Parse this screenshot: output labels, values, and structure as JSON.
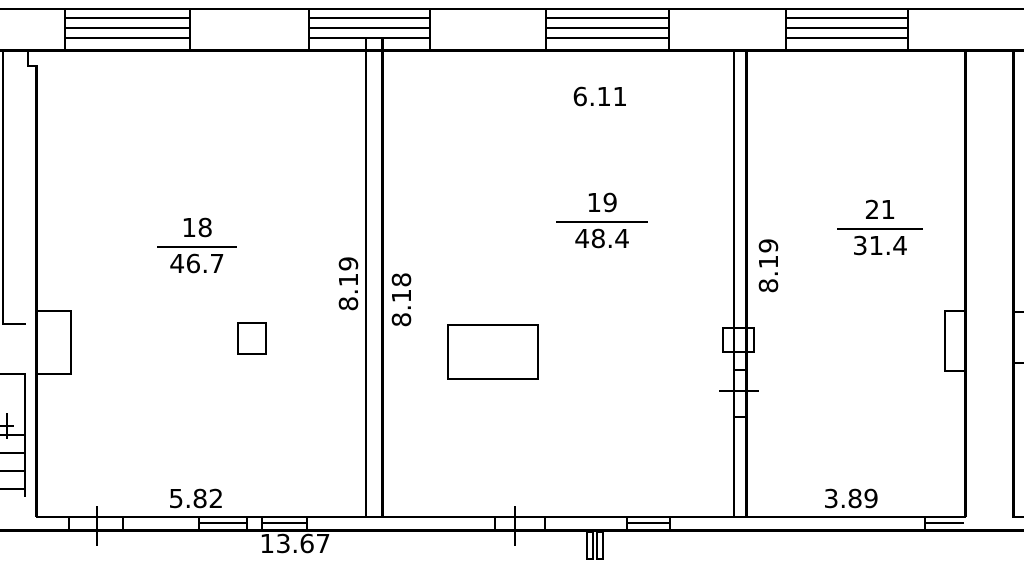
{
  "canvas": {
    "width": 1024,
    "height": 563,
    "bg": "#ffffff",
    "stroke": "#000000"
  },
  "rooms": [
    {
      "number": "18",
      "area": "46.7"
    },
    {
      "number": "19",
      "area": "48.4"
    },
    {
      "number": "21",
      "area": "31.4"
    }
  ],
  "dims": [
    {
      "text": "6.11"
    },
    {
      "text": "8.19"
    },
    {
      "text": "8.18"
    },
    {
      "text": "8.19"
    },
    {
      "text": "5.82"
    },
    {
      "text": "13.67"
    },
    {
      "text": "3.89"
    }
  ],
  "plan": {
    "rects": [
      {
        "name": "top-outer-wall-line",
        "x": 0,
        "y": 8,
        "w": 1024,
        "h": 2
      },
      {
        "name": "top-inner-wall-line",
        "x": 0,
        "y": 49,
        "w": 1024,
        "h": 3
      },
      {
        "name": "window-jamb",
        "x": 64,
        "y": 8,
        "w": 2,
        "h": 44
      },
      {
        "name": "window-jamb",
        "x": 189,
        "y": 8,
        "w": 2,
        "h": 44
      },
      {
        "name": "window-jamb",
        "x": 308,
        "y": 8,
        "w": 2,
        "h": 44
      },
      {
        "name": "window-jamb",
        "x": 429,
        "y": 8,
        "w": 2,
        "h": 44
      },
      {
        "name": "window-jamb",
        "x": 545,
        "y": 8,
        "w": 2,
        "h": 44
      },
      {
        "name": "window-jamb",
        "x": 668,
        "y": 8,
        "w": 2,
        "h": 44
      },
      {
        "name": "window-jamb",
        "x": 785,
        "y": 8,
        "w": 2,
        "h": 44
      },
      {
        "name": "window-jamb",
        "x": 907,
        "y": 8,
        "w": 2,
        "h": 44
      },
      {
        "name": "window-pane-line",
        "x": 66,
        "y": 17,
        "w": 123,
        "h": 2
      },
      {
        "name": "window-pane-line",
        "x": 66,
        "y": 27,
        "w": 123,
        "h": 2
      },
      {
        "name": "window-pane-line",
        "x": 66,
        "y": 37,
        "w": 123,
        "h": 2
      },
      {
        "name": "window-pane-line",
        "x": 310,
        "y": 17,
        "w": 119,
        "h": 2
      },
      {
        "name": "window-pane-line",
        "x": 310,
        "y": 27,
        "w": 119,
        "h": 2
      },
      {
        "name": "window-pane-line",
        "x": 310,
        "y": 37,
        "w": 119,
        "h": 2
      },
      {
        "name": "window-pane-line",
        "x": 547,
        "y": 17,
        "w": 121,
        "h": 2
      },
      {
        "name": "window-pane-line",
        "x": 547,
        "y": 27,
        "w": 121,
        "h": 2
      },
      {
        "name": "window-pane-line",
        "x": 547,
        "y": 37,
        "w": 121,
        "h": 2
      },
      {
        "name": "window-pane-line",
        "x": 787,
        "y": 17,
        "w": 120,
        "h": 2
      },
      {
        "name": "window-pane-line",
        "x": 787,
        "y": 27,
        "w": 120,
        "h": 2
      },
      {
        "name": "window-pane-line",
        "x": 787,
        "y": 37,
        "w": 120,
        "h": 2
      },
      {
        "name": "left-outer-wall-line",
        "x": 2,
        "y": 51,
        "w": 2,
        "h": 274
      },
      {
        "name": "stair-landing-line",
        "x": 2,
        "y": 323,
        "w": 24,
        "h": 2
      },
      {
        "name": "stair-landing-line",
        "x": 0,
        "y": 373,
        "w": 26,
        "h": 2
      },
      {
        "name": "stair-stringer-line",
        "x": 24,
        "y": 375,
        "w": 2,
        "h": 122
      },
      {
        "name": "stair-cross-mark-h",
        "x": 0,
        "y": 425,
        "w": 14,
        "h": 2
      },
      {
        "name": "stair-cross-mark-v",
        "x": 6,
        "y": 413,
        "w": 2,
        "h": 26
      },
      {
        "name": "stair-step-line",
        "x": 0,
        "y": 434,
        "w": 26,
        "h": 2
      },
      {
        "name": "stair-step-line",
        "x": 0,
        "y": 452,
        "w": 26,
        "h": 2
      },
      {
        "name": "stair-step-line",
        "x": 0,
        "y": 470,
        "w": 26,
        "h": 2
      },
      {
        "name": "stair-step-line",
        "x": 0,
        "y": 488,
        "w": 26,
        "h": 2
      },
      {
        "name": "wall-notch-v",
        "x": 27,
        "y": 51,
        "w": 2,
        "h": 16
      },
      {
        "name": "wall-notch-h",
        "x": 27,
        "y": 65,
        "w": 11,
        "h": 2
      },
      {
        "name": "room18-left-wall",
        "x": 35,
        "y": 65,
        "w": 3,
        "h": 452
      },
      {
        "name": "wall-18-19-left-line",
        "x": 365,
        "y": 38,
        "w": 2,
        "h": 479
      },
      {
        "name": "wall-18-19-right-line",
        "x": 381,
        "y": 38,
        "w": 3,
        "h": 479
      },
      {
        "name": "wall-19-21-left-line",
        "x": 733,
        "y": 51,
        "w": 2,
        "h": 466
      },
      {
        "name": "wall-19-21-right-line",
        "x": 745,
        "y": 51,
        "w": 3,
        "h": 466
      },
      {
        "name": "door-jamb-line",
        "x": 733,
        "y": 369,
        "w": 15,
        "h": 2
      },
      {
        "name": "dimension-tick",
        "x": 719,
        "y": 390,
        "w": 40,
        "h": 2
      },
      {
        "name": "door-jamb-line",
        "x": 733,
        "y": 416,
        "w": 15,
        "h": 2
      },
      {
        "name": "room21-right-wall",
        "x": 964,
        "y": 51,
        "w": 3,
        "h": 466
      },
      {
        "name": "shaft-right-wall",
        "x": 1012,
        "y": 51,
        "w": 3,
        "h": 466
      },
      {
        "name": "edge-tick",
        "x": 1015,
        "y": 311,
        "w": 9,
        "h": 2
      },
      {
        "name": "edge-tick",
        "x": 1015,
        "y": 362,
        "w": 9,
        "h": 2
      },
      {
        "name": "bottom-outer-wall-line",
        "x": 0,
        "y": 529,
        "w": 1024,
        "h": 3
      },
      {
        "name": "bottom-inner-wall-line",
        "x": 36,
        "y": 516,
        "w": 930,
        "h": 2
      },
      {
        "name": "bottom-inner-wall-line",
        "x": 1012,
        "y": 516,
        "w": 12,
        "h": 2
      },
      {
        "name": "window-jamb",
        "x": 68,
        "y": 516,
        "w": 2,
        "h": 16
      },
      {
        "name": "window-jamb",
        "x": 122,
        "y": 516,
        "w": 2,
        "h": 16
      },
      {
        "name": "window-jamb",
        "x": 198,
        "y": 516,
        "w": 2,
        "h": 16
      },
      {
        "name": "window-jamb",
        "x": 246,
        "y": 516,
        "w": 2,
        "h": 16
      },
      {
        "name": "window-jamb",
        "x": 261,
        "y": 516,
        "w": 2,
        "h": 16
      },
      {
        "name": "window-jamb",
        "x": 306,
        "y": 516,
        "w": 2,
        "h": 16
      },
      {
        "name": "window-jamb",
        "x": 494,
        "y": 516,
        "w": 2,
        "h": 16
      },
      {
        "name": "window-jamb",
        "x": 544,
        "y": 516,
        "w": 2,
        "h": 16
      },
      {
        "name": "window-jamb",
        "x": 626,
        "y": 516,
        "w": 2,
        "h": 16
      },
      {
        "name": "window-jamb",
        "x": 669,
        "y": 516,
        "w": 2,
        "h": 16
      },
      {
        "name": "window-jamb",
        "x": 924,
        "y": 516,
        "w": 2,
        "h": 16
      },
      {
        "name": "window-pane-line",
        "x": 198,
        "y": 522,
        "w": 48,
        "h": 2
      },
      {
        "name": "window-pane-line",
        "x": 261,
        "y": 522,
        "w": 45,
        "h": 2
      },
      {
        "name": "window-pane-line",
        "x": 626,
        "y": 522,
        "w": 43,
        "h": 2
      },
      {
        "name": "window-pane-line",
        "x": 924,
        "y": 522,
        "w": 40,
        "h": 2
      },
      {
        "name": "dimension-tick",
        "x": 96,
        "y": 506,
        "w": 2,
        "h": 40
      },
      {
        "name": "dimension-tick",
        "x": 514,
        "y": 506,
        "w": 2,
        "h": 40
      }
    ],
    "boxes": [
      {
        "name": "radiator-room18",
        "x": 36,
        "y": 310,
        "w": 36,
        "h": 65
      },
      {
        "name": "fixture-room18",
        "x": 237,
        "y": 322,
        "w": 30,
        "h": 33
      },
      {
        "name": "table-room19",
        "x": 447,
        "y": 324,
        "w": 92,
        "h": 56
      },
      {
        "name": "wall-vent-19-21",
        "x": 722,
        "y": 327,
        "w": 33,
        "h": 26
      },
      {
        "name": "radiator-room21",
        "x": 944,
        "y": 310,
        "w": 22,
        "h": 62
      },
      {
        "name": "entrance-step-left",
        "x": 586,
        "y": 531,
        "w": 8,
        "h": 29
      },
      {
        "name": "entrance-step-right",
        "x": 596,
        "y": 531,
        "w": 8,
        "h": 29
      }
    ]
  }
}
